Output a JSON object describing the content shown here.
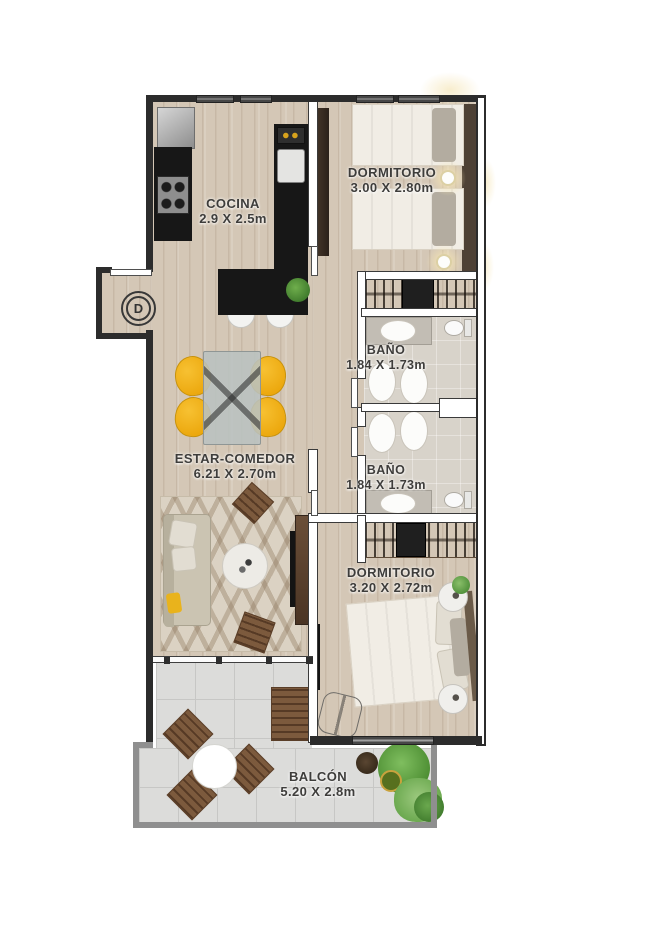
{
  "unit": {
    "label": "D"
  },
  "rooms": {
    "cocina": {
      "name": "COCINA",
      "dims": "2.9 X 2.5m"
    },
    "dormitorio1": {
      "name": "DORMITORIO",
      "dims": "3.00 X 2.80m"
    },
    "bano1": {
      "name": "BAÑO",
      "dims": "1.84 X 1.73m"
    },
    "bano2": {
      "name": "BAÑO",
      "dims": "1.84 X 1.73m"
    },
    "estar_comedor": {
      "name": "ESTAR-COMEDOR",
      "dims": "6.21 X 2.70m"
    },
    "dormitorio2": {
      "name": "DORMITORIO",
      "dims": "3.20 X 2.72m"
    },
    "balcon": {
      "name": "BALCÓN",
      "dims": "5.20 X 2.8m"
    }
  },
  "colors": {
    "exterior_wall": "#2c2c2c",
    "balcony_wall": "#8f8f8f",
    "wood_floor": "#d4c7b6",
    "balcony_tile": "#dcdcda",
    "kitchen_counter": "#171717",
    "accent_yellow": "#f2b118",
    "plant_green": "#5d9c40",
    "label_text": "#3e3d3b"
  }
}
